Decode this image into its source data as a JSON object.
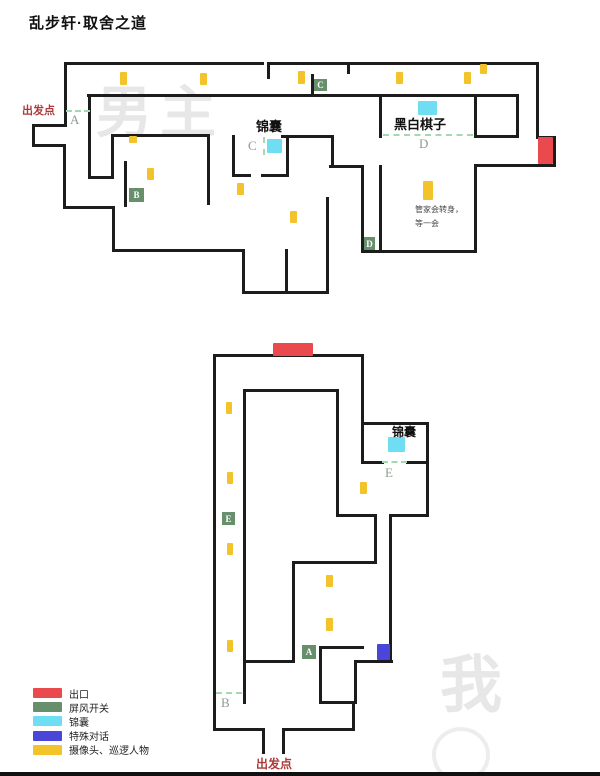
{
  "title": "乱步轩·取舍之道",
  "colors": {
    "wall": "#1c1c1c",
    "exit": "#ea4a4e",
    "switch": "#678f6b",
    "bag": "#6fdef2",
    "dialog": "#4a46d8",
    "patrol": "#f2c32a",
    "door_dash": "#a5d8ae",
    "letter_gray": "#8d9b8d",
    "start_text": "#ad3a3a",
    "watermark": "#e7e7e7"
  },
  "legend": {
    "items": [
      {
        "type": "exit",
        "label": "出口"
      },
      {
        "type": "switch",
        "label": "屏风开关"
      },
      {
        "type": "bag",
        "label": "锦囊"
      },
      {
        "type": "dialog",
        "label": "特殊对话"
      },
      {
        "type": "patrol",
        "label": "摄像头、巡逻人物"
      }
    ]
  },
  "maps": [
    {
      "name": "upper-floor",
      "watermark": {
        "t": "男主",
        "x": 96,
        "y": 68,
        "size": 56
      },
      "walls": [
        [
          65,
          63,
          262,
          63
        ],
        [
          268,
          63,
          537,
          63
        ],
        [
          268,
          63,
          268,
          77
        ],
        [
          348,
          63,
          348,
          72
        ],
        [
          65,
          63,
          65,
          125
        ],
        [
          65,
          125,
          33,
          125
        ],
        [
          33,
          125,
          33,
          145
        ],
        [
          33,
          145,
          64,
          145
        ],
        [
          64,
          145,
          64,
          207
        ],
        [
          64,
          207,
          113,
          207
        ],
        [
          113,
          207,
          113,
          250
        ],
        [
          113,
          250,
          243,
          250
        ],
        [
          243,
          250,
          243,
          292
        ],
        [
          243,
          292,
          327,
          292
        ],
        [
          327,
          198,
          327,
          292
        ],
        [
          286,
          250,
          286,
          292
        ],
        [
          537,
          63,
          537,
          137
        ],
        [
          537,
          137,
          554,
          137
        ],
        [
          554,
          137,
          554,
          165
        ],
        [
          554,
          165,
          475,
          165
        ],
        [
          475,
          165,
          475,
          251
        ],
        [
          475,
          251,
          362,
          251
        ],
        [
          362,
          166,
          362,
          251
        ],
        [
          330,
          166,
          362,
          166
        ],
        [
          332,
          136,
          332,
          166
        ],
        [
          282,
          136,
          332,
          136
        ],
        [
          380,
          166,
          380,
          248
        ],
        [
          88,
          95,
          517,
          95
        ],
        [
          312,
          75,
          312,
          95
        ],
        [
          89,
          95,
          89,
          177
        ],
        [
          89,
          177,
          112,
          177
        ],
        [
          112,
          135,
          112,
          177
        ],
        [
          112,
          135,
          208,
          135
        ],
        [
          208,
          135,
          208,
          203
        ],
        [
          125,
          162,
          125,
          205
        ],
        [
          233,
          136,
          233,
          175
        ],
        [
          287,
          136,
          287,
          175
        ],
        [
          233,
          175,
          249,
          175
        ],
        [
          262,
          175,
          287,
          175
        ],
        [
          380,
          95,
          380,
          136
        ],
        [
          475,
          95,
          475,
          136
        ],
        [
          517,
          95,
          517,
          136
        ],
        [
          475,
          136,
          517,
          136
        ]
      ],
      "dashes": [
        {
          "x": 66,
          "y": 111,
          "len": 24,
          "dir": "h"
        },
        {
          "x": 264,
          "y": 137,
          "len": 18,
          "dir": "v"
        },
        {
          "x": 383,
          "y": 135,
          "len": 90,
          "dir": "h"
        }
      ],
      "markers": [
        {
          "type": "exit",
          "x": 538,
          "y": 137,
          "w": 15,
          "h": 27
        },
        {
          "type": "bag",
          "x": 267,
          "y": 139,
          "w": 15,
          "h": 14
        },
        {
          "type": "bag",
          "x": 418,
          "y": 101,
          "w": 19,
          "h": 14
        },
        {
          "type": "patrol",
          "x": 120,
          "y": 72,
          "w": 7,
          "h": 13
        },
        {
          "type": "patrol",
          "x": 200,
          "y": 73,
          "w": 7,
          "h": 12
        },
        {
          "type": "patrol",
          "x": 298,
          "y": 71,
          "w": 7,
          "h": 13
        },
        {
          "type": "patrol",
          "x": 396,
          "y": 72,
          "w": 7,
          "h": 12
        },
        {
          "type": "patrol",
          "x": 464,
          "y": 72,
          "w": 7,
          "h": 12
        },
        {
          "type": "patrol",
          "x": 480,
          "y": 64,
          "w": 7,
          "h": 10
        },
        {
          "type": "patrol",
          "x": 129,
          "y": 136,
          "w": 8,
          "h": 7
        },
        {
          "type": "patrol",
          "x": 147,
          "y": 168,
          "w": 7,
          "h": 12
        },
        {
          "type": "patrol",
          "x": 237,
          "y": 183,
          "w": 7,
          "h": 12
        },
        {
          "type": "patrol",
          "x": 290,
          "y": 211,
          "w": 7,
          "h": 12
        },
        {
          "type": "patrol",
          "x": 423,
          "y": 181,
          "w": 10,
          "h": 19
        }
      ],
      "switch_squares": [
        {
          "letter": "C",
          "x": 314,
          "y": 79,
          "w": 13,
          "h": 12
        },
        {
          "letter": "B",
          "x": 129,
          "y": 188,
          "w": 15,
          "h": 14
        },
        {
          "letter": "D",
          "x": 364,
          "y": 237,
          "w": 11,
          "h": 13
        }
      ],
      "letters": [
        {
          "ch": "A",
          "x": 70,
          "y": 112
        },
        {
          "ch": "C",
          "x": 248,
          "y": 138
        },
        {
          "ch": "D",
          "x": 419,
          "y": 136
        }
      ],
      "texts": [
        {
          "t": "出发点",
          "x": 22,
          "y": 102,
          "size": 11,
          "bold": true,
          "color": "#ad3a3a"
        },
        {
          "t": "锦囊",
          "x": 256,
          "y": 116,
          "size": 13,
          "bold": true,
          "color": "#111"
        },
        {
          "t": "黑白棋子",
          "x": 394,
          "y": 114,
          "size": 13,
          "bold": true,
          "color": "#111"
        },
        {
          "t": "管家会转身，",
          "x": 415,
          "y": 204,
          "size": 8,
          "bold": false,
          "color": "#444"
        },
        {
          "t": "等一会",
          "x": 415,
          "y": 218,
          "size": 8,
          "bold": false,
          "color": "#444"
        }
      ]
    },
    {
      "name": "lower-floor",
      "watermark": {
        "t": "我",
        "x": 440,
        "y": 634,
        "size": 62
      },
      "walls": [
        [
          214,
          355,
          362,
          355
        ],
        [
          214,
          355,
          214,
          729
        ],
        [
          214,
          729,
          263,
          729
        ],
        [
          263,
          729,
          263,
          752
        ],
        [
          283,
          729,
          283,
          752
        ],
        [
          283,
          729,
          353,
          729
        ],
        [
          353,
          702,
          353,
          729
        ],
        [
          320,
          702,
          355,
          702
        ],
        [
          320,
          647,
          320,
          702
        ],
        [
          320,
          647,
          362,
          647
        ],
        [
          355,
          661,
          355,
          702
        ],
        [
          355,
          661,
          391,
          661
        ],
        [
          362,
          355,
          362,
          462
        ],
        [
          362,
          423,
          427,
          423
        ],
        [
          427,
          423,
          427,
          462
        ],
        [
          407,
          462,
          427,
          462
        ],
        [
          363,
          462,
          382,
          462
        ],
        [
          427,
          462,
          427,
          515
        ],
        [
          390,
          515,
          427,
          515
        ],
        [
          390,
          515,
          390,
          661
        ],
        [
          244,
          390,
          244,
          702
        ],
        [
          244,
          390,
          337,
          390
        ],
        [
          337,
          390,
          337,
          515
        ],
        [
          337,
          515,
          375,
          515
        ],
        [
          375,
          515,
          375,
          562
        ],
        [
          293,
          562,
          375,
          562
        ],
        [
          293,
          562,
          293,
          661
        ],
        [
          244,
          661,
          293,
          661
        ]
      ],
      "dashes": [
        {
          "x": 382,
          "y": 462,
          "len": 25,
          "dir": "h"
        },
        {
          "x": 216,
          "y": 693,
          "len": 26,
          "dir": "h"
        }
      ],
      "markers": [
        {
          "type": "exit",
          "x": 273,
          "y": 343,
          "w": 40,
          "h": 13
        },
        {
          "type": "bag",
          "x": 388,
          "y": 437,
          "w": 17,
          "h": 15
        },
        {
          "type": "dialog",
          "x": 377,
          "y": 644,
          "w": 13,
          "h": 16
        },
        {
          "type": "patrol",
          "x": 226,
          "y": 402,
          "w": 6,
          "h": 12
        },
        {
          "type": "patrol",
          "x": 227,
          "y": 472,
          "w": 6,
          "h": 12
        },
        {
          "type": "patrol",
          "x": 227,
          "y": 543,
          "w": 6,
          "h": 12
        },
        {
          "type": "patrol",
          "x": 227,
          "y": 640,
          "w": 6,
          "h": 12
        },
        {
          "type": "patrol",
          "x": 360,
          "y": 482,
          "w": 7,
          "h": 12
        },
        {
          "type": "patrol",
          "x": 326,
          "y": 575,
          "w": 7,
          "h": 12
        },
        {
          "type": "patrol",
          "x": 326,
          "y": 618,
          "w": 7,
          "h": 13
        }
      ],
      "switch_squares": [
        {
          "letter": "E",
          "x": 222,
          "y": 512,
          "w": 13,
          "h": 13
        },
        {
          "letter": "A",
          "x": 302,
          "y": 645,
          "w": 14,
          "h": 14
        }
      ],
      "letters": [
        {
          "ch": "E",
          "x": 385,
          "y": 465
        },
        {
          "ch": "B",
          "x": 221,
          "y": 695
        }
      ],
      "texts": [
        {
          "t": "锦囊",
          "x": 392,
          "y": 423,
          "size": 12,
          "bold": true,
          "color": "#111"
        },
        {
          "t": "出发点",
          "x": 256,
          "y": 755,
          "size": 12,
          "bold": true,
          "color": "#ad3a3a"
        }
      ]
    }
  ]
}
